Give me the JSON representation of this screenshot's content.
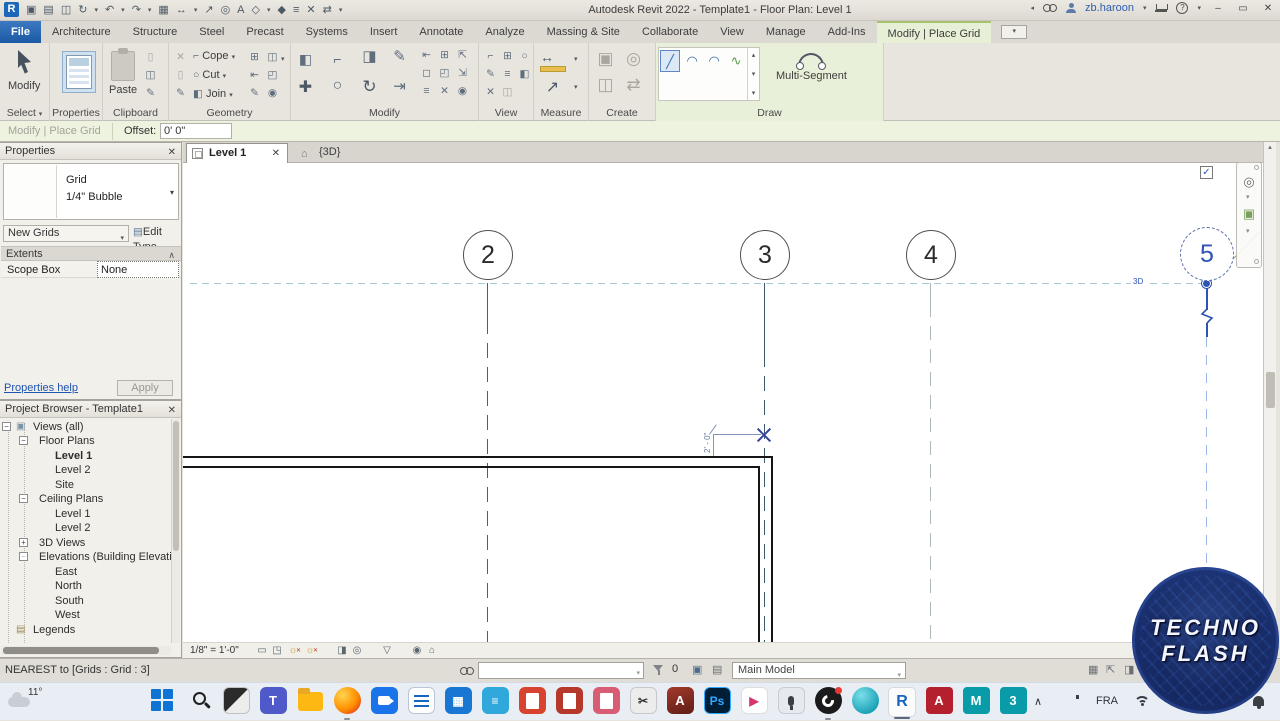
{
  "colors": {
    "accent_blue": "#2d53b5",
    "contextual_green": "#e9f0da",
    "ribbon_gray": "#e8e5df",
    "file_tab_blue": "#1b5aa4",
    "wall_black": "#161616",
    "grid_dark": "#3e5a6d",
    "grid_light": "#aeb7ba",
    "align_dash_teal": "#a6c9d6",
    "selection_blue_light": "#9db6e6",
    "logo_navy": "#182a63"
  },
  "icons": {
    "caret": "▾",
    "caret_up": "▴",
    "back": "◂",
    "minimize": "–",
    "restore": "▭",
    "close": "✕",
    "window": "▣",
    "open": "▤",
    "save": "◫",
    "sync": "↻",
    "undo": "↶",
    "redo": "↷",
    "print": "▦",
    "dim": "↔",
    "measure_diag": "↗",
    "tag": "◎",
    "text": "A",
    "box3d": "◇",
    "section": "◆",
    "lines": "≡",
    "switch": "⇄",
    "check": "✓",
    "home": "⌂",
    "plus": "+",
    "minus": "−",
    "scissors": "✂",
    "pencil": "✎",
    "sheet": "▯",
    "circle": "○",
    "halfbox": "◧",
    "cope": "⌐",
    "move": "✚",
    "rotate": "↻",
    "align": "⇤",
    "offset": "⇥",
    "boxes": "⊞",
    "corner": "◰",
    "bar": "▭",
    "mirror": "◨",
    "pin": "◉",
    "x": "✕",
    "split": "◻",
    "arrow_in": "⇱",
    "arrow_out": "⇲",
    "line": "╱",
    "arc": "◠",
    "spline": "∿",
    "sun": "☼",
    "cube": "◳",
    "eye": "◎",
    "tri": "▽",
    "target": "◉",
    "wheel": "◎",
    "zoom_region": "▣",
    "chev_up": "∧"
  },
  "title_bar": {
    "title": "Autodesk Revit 2022 - Template1 - Floor Plan: Level 1",
    "user": "zb.haroon",
    "help": "?"
  },
  "tabs": {
    "file": "File",
    "items": [
      "Architecture",
      "Structure",
      "Steel",
      "Precast",
      "Systems",
      "Insert",
      "Annotate",
      "Analyze",
      "Massing & Site",
      "Collaborate",
      "View",
      "Manage",
      "Add-Ins"
    ],
    "contextual": "Modify | Place Grid"
  },
  "ribbon": {
    "modify_big": "Modify",
    "select": "Select",
    "paste": "Paste",
    "cope": "Cope",
    "cut": "Cut",
    "join": "Join",
    "multi_segment": "Multi-Segment",
    "labels": {
      "properties": "Properties",
      "clipboard": "Clipboard",
      "geometry": "Geometry",
      "modify": "Modify",
      "view": "View",
      "measure": "Measure",
      "create": "Create",
      "draw": "Draw"
    }
  },
  "options_bar": {
    "mode": "Modify | Place Grid",
    "offset_label": "Offset:",
    "offset_value": "0' 0\""
  },
  "properties": {
    "title": "Properties",
    "type_name": "Grid",
    "type_desc": "1/4\" Bubble",
    "selector": "New Grids",
    "edit_type": "Edit Type",
    "extents": "Extents",
    "scope_box": "Scope Box",
    "scope_value": "None",
    "help": "Properties help",
    "apply": "Apply"
  },
  "browser": {
    "title": "Project Browser - Template1",
    "items": [
      "Views (all)",
      "Floor Plans",
      "Level 1",
      "Level 2",
      "Site",
      "Ceiling Plans",
      "Level 1",
      "Level 2",
      "3D Views",
      "Elevations (Building Elevatio",
      "East",
      "North",
      "South",
      "West",
      "Legends"
    ]
  },
  "view_tabs": {
    "level1": "Level 1",
    "threed": "{3D}"
  },
  "canvas": {
    "bubbles": [
      "2",
      "3",
      "4",
      "5"
    ],
    "threed_label": "3D",
    "temp_dim": "2' - 0\"",
    "nav_2d": "2D"
  },
  "view_bar": {
    "scale": "1/8\" = 1'-0\""
  },
  "status_bar": {
    "hint": "NEAREST  to [Grids : Grid : 3]",
    "count": "0",
    "main_model": "Main Model"
  },
  "taskbar": {
    "weather": "11°",
    "teams": "T",
    "ps": "Ps",
    "acad": "A",
    "acad2": "A",
    "maya": "M",
    "max": "3",
    "revit": "R",
    "calc": "▦",
    "notes": "≡",
    "snip": "✂",
    "play": "▶",
    "lang": "FRA"
  },
  "logo": {
    "line1": "TECHNO",
    "line2": "FLASH"
  }
}
